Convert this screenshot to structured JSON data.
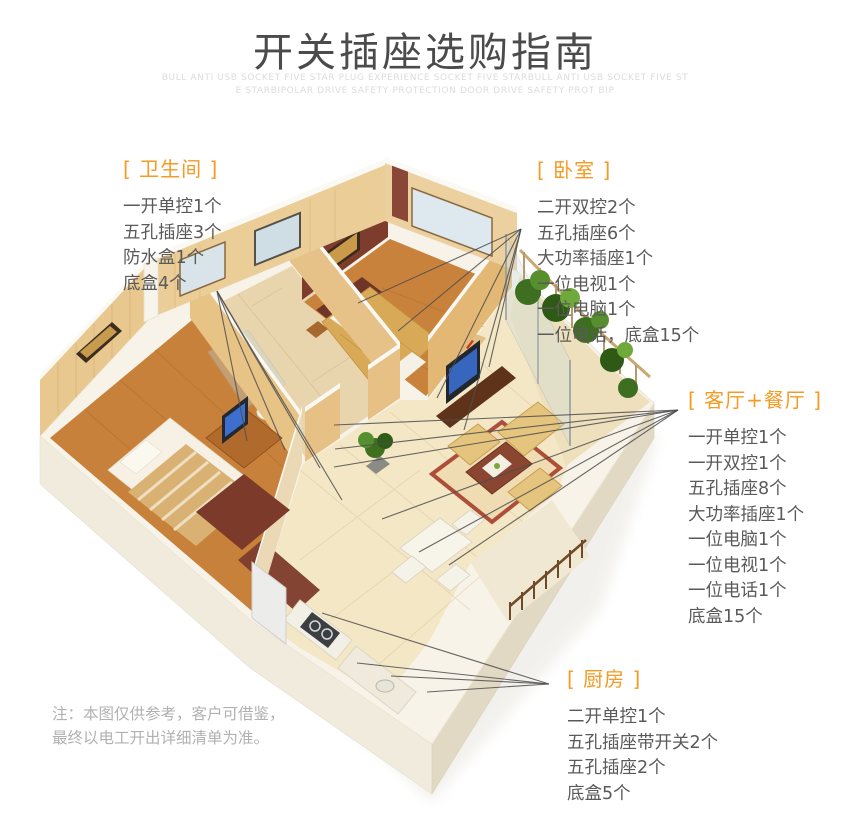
{
  "header": {
    "title": "开关插座选购指南",
    "watermark_line1": "BULL ANTI USB SOCKET FIVE STAR PLUG EXPERIENCE SOCKET FIVE STARBULL ANTI USB SOCKET FIVE ST",
    "watermark_line2": "E STARBIPOLAR DRIVE SAFETY PROTECTION DOOR  DRIVE SAFETY PROT BIP"
  },
  "colors": {
    "accent_orange": "#f59a23",
    "title_gray": "#4b4b4b",
    "body_gray": "#5a5a5a",
    "note_gray": "#b1b1b1",
    "watermark_gray": "#dcdcdc",
    "leader_line": "#4d4d4d"
  },
  "rooms": {
    "bathroom": {
      "label": "[ 卫生间 ]",
      "items": [
        "一开单控1个",
        "五孔插座3个",
        "防水盒1个",
        "底盒4个"
      ]
    },
    "bedroom": {
      "label": "[ 卧室 ]",
      "items": [
        "二开双控2个",
        "五孔插座6个",
        "大功率插座1个",
        "一位电视1个",
        "一位电脑1个",
        "一位电话，底盒15个"
      ]
    },
    "living_dining": {
      "label": "[ 客厅+餐厅 ]",
      "items": [
        "一开单控1个",
        "一开双控1个",
        "五孔插座8个",
        "大功率插座1个",
        "一位电脑1个",
        "一位电视1个",
        "一位电话1个",
        "底盒15个"
      ]
    },
    "kitchen": {
      "label": "[ 厨房 ]",
      "items": [
        "二开单控1个",
        "五孔插座带开关2个",
        "五孔插座2个",
        "底盒5个"
      ]
    }
  },
  "note": {
    "line1": "注：本图仅供参考，客户可借鉴，",
    "line2": "最终以电工开出详细清单为准。"
  }
}
